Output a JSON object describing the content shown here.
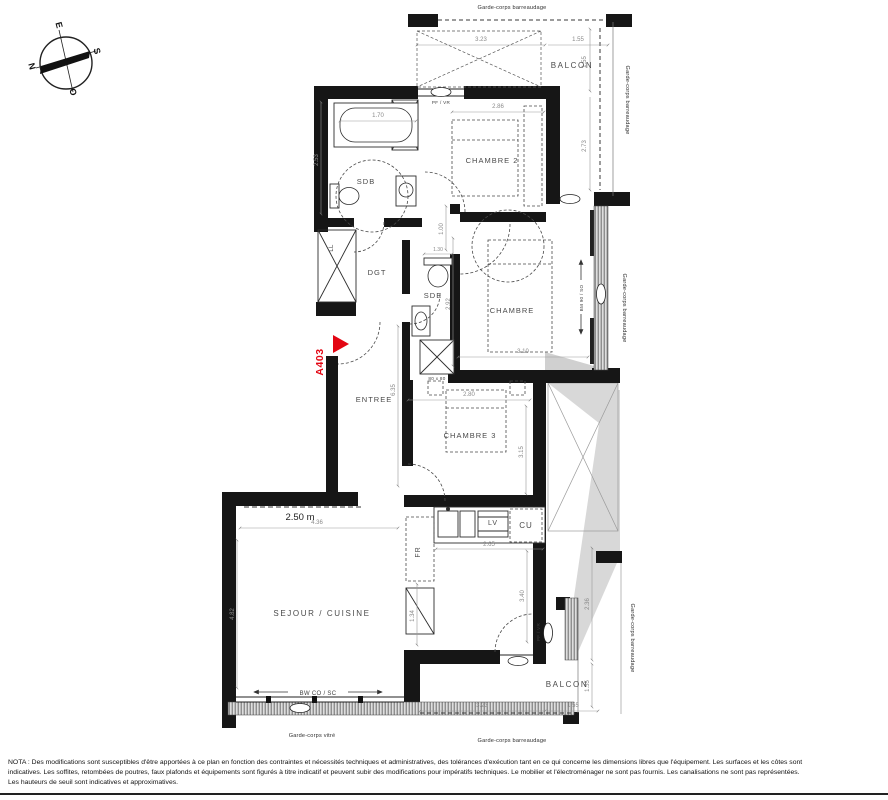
{
  "plan": {
    "unit_id": "A403",
    "ceiling_height": "2.50 m",
    "compass": {
      "n": "N",
      "e": "E",
      "s": "S",
      "o": "O"
    },
    "rooms": {
      "balcon_top": "BALCON",
      "chambre2": "CHAMBRE 2",
      "sdb": "SDB",
      "dgt": "DGT",
      "sde": "SDE",
      "chambre": "CHAMBRE",
      "entree": "ENTREE",
      "chambre3": "CHAMBRE 3",
      "sejour": "SEJOUR / CUISINE",
      "balcon_bottom": "BALCON"
    },
    "fixtures": {
      "ll": "LL",
      "lv": "LV",
      "cu": "CU",
      "fr": "FR",
      "shower_size": "80 x 80"
    },
    "window_codes": {
      "chambre2_top": "PF / VR",
      "chambre_right": "BM 90 / SO",
      "sejour_slider": "BW CO / SC",
      "balcon_door": "PF / VR"
    },
    "guardrails": {
      "top": "Garde-corps barreaudage",
      "right_upper": "Garde-corps barreaudage",
      "right_mid": "Garde-corps barreaudage",
      "right_lower": "Garde-corps barreaudage",
      "bottom_glass": "Garde-corps vitré",
      "bottom": "Garde-corps barreaudage"
    },
    "dims": {
      "balcon_top_w": "3.23",
      "balcon_top_w2": "1.55",
      "balcon_top_h": "1.55",
      "balcon_right_h": "2.73",
      "bath": "1.70",
      "sdb_h": "2.53",
      "chambre2_w": "2.86",
      "corridor": "1.00",
      "sde_w": "1.30",
      "chambre_h": "2.92",
      "chambre_w": "3.10",
      "entree_h": "6.35",
      "chambre3_w": "2.80",
      "chambre3_h": "3.15",
      "kitchen_w": "2.65",
      "sejour_w": "4.36",
      "sejour_h": "4.82",
      "sejour_right_h": "3.40",
      "hall_w": "1.34",
      "balcon_bot_w": "3.23",
      "balcon_bot_w2": "1.55",
      "balcon_bot_h": "1.55",
      "balcon_bot_right_h": "2.36"
    }
  },
  "nota": {
    "l1": "NOTA : Des modifications sont susceptibles d'être apportées à ce plan en fonction des contraintes et nécessités techniques et administratives, des tolérances d'exécution tant en ce qui concerne les dimensions libres que l'équipement. Les surfaces et les côtes sont",
    "l2": "indicatives. Les soffites, retombées de poutres, faux plafonds et équipements sont figurés à titre indicatif et peuvent subir des modifications pour impératifs techniques. Le mobilier et l'électroménager ne sont pas fournis. Les canalisations ne sont pas représentées.",
    "l3": "Les hauteurs de seuil sont indicatives et approximatives."
  }
}
